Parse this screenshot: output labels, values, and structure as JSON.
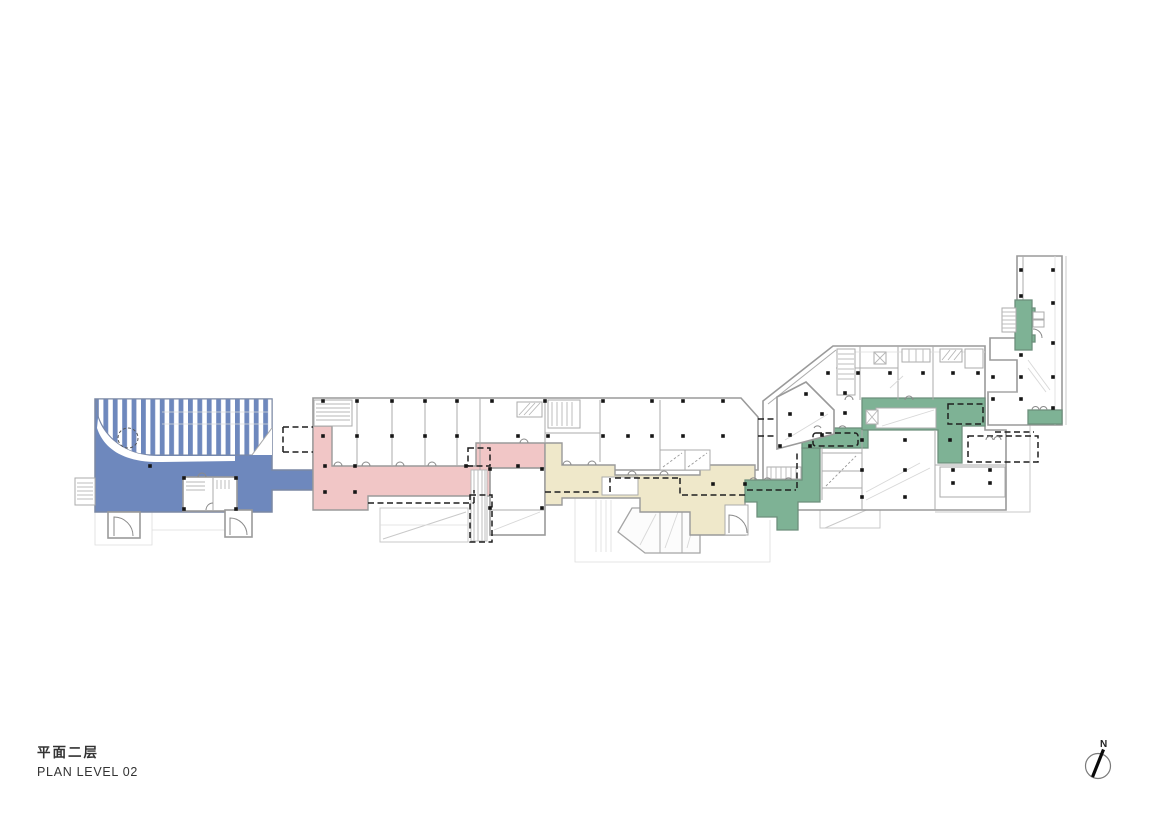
{
  "title_block": {
    "title_cn": "平面二层",
    "title_en": "PLAN LEVEL 02"
  },
  "north_arrow": {
    "label": "N"
  },
  "colors": {
    "blue": "#6E88BD",
    "pink": "#F1C6C6",
    "cream": "#EFE8CA",
    "green": "#7EB295",
    "wall": "#9A9A9A",
    "dash": "#1F1F1F",
    "underlay": "#C9C9C9",
    "text": "#333333"
  },
  "zones": [
    {
      "id": "zone-blue",
      "color_key": "blue"
    },
    {
      "id": "zone-pink",
      "color_key": "pink"
    },
    {
      "id": "zone-cream",
      "color_key": "cream"
    },
    {
      "id": "zone-green",
      "color_key": "green"
    }
  ]
}
